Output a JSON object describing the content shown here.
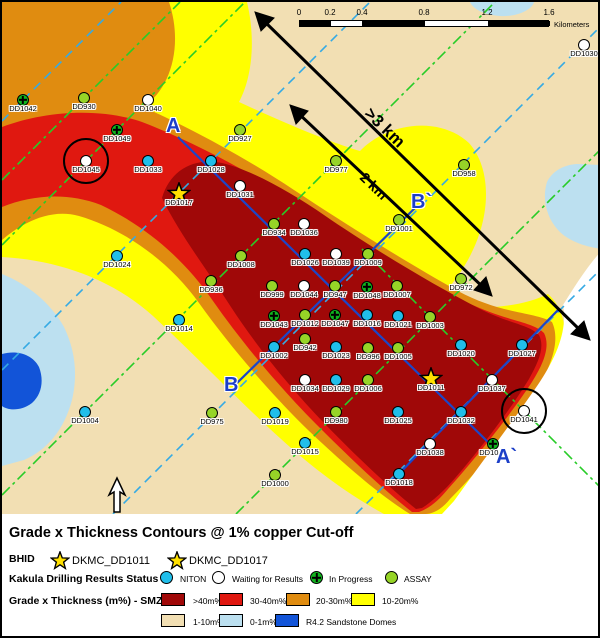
{
  "map": {
    "section_labels": {
      "a": "A",
      "a_prime": "A`",
      "b": "B",
      "b_prime": "B`"
    },
    "distance_labels": {
      "long": ">3 km",
      "short": "2 km"
    },
    "scalebar": {
      "ticks": [
        "0",
        "0.2",
        "0.4",
        "0.8",
        "1.2",
        "1.6"
      ],
      "unit": "Kilometers"
    },
    "region_colors": {
      "gt40": "#A00808",
      "r30_40": "#E01810",
      "r20_30": "#E08C10",
      "r10_20": "#FFFF00",
      "r1_10": "#F2DFB3",
      "r0_1": "#BCE0F0",
      "sandstone_dome": "#1254D8",
      "no_data": "#FFFFFF"
    },
    "status_colors": {
      "niton": "#20BEEA",
      "waiting": "#FFFFFF",
      "inprogress": "#10B41E",
      "assay": "#96D427",
      "star": "#FFE000"
    },
    "holes": [
      {
        "label": "DD1030",
        "x": 582,
        "y": 43,
        "status": "waiting"
      },
      {
        "label": "DD1042",
        "x": 21,
        "y": 98,
        "status": "inprogress"
      },
      {
        "label": "DD930",
        "x": 82,
        "y": 96,
        "status": "assay"
      },
      {
        "label": "DD1040",
        "x": 146,
        "y": 98,
        "status": "waiting"
      },
      {
        "label": "DD1049",
        "x": 115,
        "y": 128,
        "status": "inprogress"
      },
      {
        "label": "DD1045",
        "x": 84,
        "y": 159,
        "status": "waiting",
        "circled": true
      },
      {
        "label": "DD1033",
        "x": 146,
        "y": 159,
        "status": "niton"
      },
      {
        "label": "DD1028",
        "x": 209,
        "y": 159,
        "status": "niton"
      },
      {
        "label": "DD927",
        "x": 238,
        "y": 128,
        "status": "assay"
      },
      {
        "label": "DD977",
        "x": 334,
        "y": 159,
        "status": "assay"
      },
      {
        "label": "DD958",
        "x": 462,
        "y": 163,
        "status": "assay"
      },
      {
        "label": "DD1017",
        "x": 177,
        "y": 192,
        "status": "star"
      },
      {
        "label": "DD1031",
        "x": 238,
        "y": 184,
        "status": "waiting"
      },
      {
        "label": "DD934",
        "x": 272,
        "y": 222,
        "status": "assay"
      },
      {
        "label": "DD1036",
        "x": 302,
        "y": 222,
        "status": "waiting"
      },
      {
        "label": "DD1001",
        "x": 397,
        "y": 218,
        "status": "assay"
      },
      {
        "label": "DD1024",
        "x": 115,
        "y": 254,
        "status": "niton"
      },
      {
        "label": "DD1008",
        "x": 239,
        "y": 254,
        "status": "assay"
      },
      {
        "label": "DD1026",
        "x": 303,
        "y": 252,
        "status": "niton"
      },
      {
        "label": "DD1039",
        "x": 334,
        "y": 252,
        "status": "waiting"
      },
      {
        "label": "DD1009",
        "x": 366,
        "y": 252,
        "status": "assay"
      },
      {
        "label": "DD972",
        "x": 459,
        "y": 277,
        "status": "assay"
      },
      {
        "label": "DD936",
        "x": 209,
        "y": 279,
        "status": "assay"
      },
      {
        "label": "DD999",
        "x": 270,
        "y": 284,
        "status": "assay"
      },
      {
        "label": "DD1044",
        "x": 302,
        "y": 284,
        "status": "waiting"
      },
      {
        "label": "DD947",
        "x": 333,
        "y": 284,
        "status": "assay"
      },
      {
        "label": "DD1048",
        "x": 365,
        "y": 285,
        "status": "inprogress"
      },
      {
        "label": "DD1007",
        "x": 395,
        "y": 284,
        "status": "assay"
      },
      {
        "label": "DD1014",
        "x": 177,
        "y": 318,
        "status": "niton"
      },
      {
        "label": "DD1043",
        "x": 272,
        "y": 314,
        "status": "inprogress"
      },
      {
        "label": "DD1012",
        "x": 303,
        "y": 313,
        "status": "assay"
      },
      {
        "label": "DD1047",
        "x": 333,
        "y": 313,
        "status": "inprogress"
      },
      {
        "label": "DD1016",
        "x": 365,
        "y": 313,
        "status": "niton"
      },
      {
        "label": "DD1021",
        "x": 396,
        "y": 314,
        "status": "niton"
      },
      {
        "label": "DD1003",
        "x": 428,
        "y": 315,
        "status": "assay"
      },
      {
        "label": "DD942",
        "x": 303,
        "y": 337,
        "status": "assay"
      },
      {
        "label": "DD1002",
        "x": 272,
        "y": 345,
        "status": "niton"
      },
      {
        "label": "DD1023",
        "x": 334,
        "y": 345,
        "status": "niton"
      },
      {
        "label": "DD996",
        "x": 366,
        "y": 346,
        "status": "assay"
      },
      {
        "label": "DD1005",
        "x": 396,
        "y": 346,
        "status": "assay"
      },
      {
        "label": "DD1020",
        "x": 459,
        "y": 343,
        "status": "niton"
      },
      {
        "label": "DD1027",
        "x": 520,
        "y": 343,
        "status": "niton"
      },
      {
        "label": "DD1034",
        "x": 303,
        "y": 378,
        "status": "waiting"
      },
      {
        "label": "DD1029",
        "x": 334,
        "y": 378,
        "status": "niton"
      },
      {
        "label": "DD1006",
        "x": 366,
        "y": 378,
        "status": "assay"
      },
      {
        "label": "DD1011",
        "x": 429,
        "y": 377,
        "status": "star"
      },
      {
        "label": "DD1037",
        "x": 490,
        "y": 378,
        "status": "waiting"
      },
      {
        "label": "DD1004",
        "x": 83,
        "y": 410,
        "status": "niton"
      },
      {
        "label": "DD975",
        "x": 210,
        "y": 411,
        "status": "assay"
      },
      {
        "label": "DD1019",
        "x": 273,
        "y": 411,
        "status": "niton"
      },
      {
        "label": "DD980",
        "x": 334,
        "y": 410,
        "status": "assay"
      },
      {
        "label": "DD1025",
        "x": 396,
        "y": 410,
        "status": "niton"
      },
      {
        "label": "DD1032",
        "x": 459,
        "y": 410,
        "status": "niton"
      },
      {
        "label": "DD1041",
        "x": 522,
        "y": 409,
        "status": "waiting",
        "circled": true
      },
      {
        "label": "DD1015",
        "x": 303,
        "y": 441,
        "status": "niton"
      },
      {
        "label": "DD1038",
        "x": 428,
        "y": 442,
        "status": "waiting"
      },
      {
        "label": "DD1046",
        "x": 491,
        "y": 442,
        "status": "inprogress"
      },
      {
        "label": "DD1000",
        "x": 273,
        "y": 473,
        "status": "assay"
      },
      {
        "label": "DD1018",
        "x": 397,
        "y": 472,
        "status": "niton"
      }
    ]
  },
  "legend": {
    "title": "Grade x Thickness Contours @ 1% copper Cut-off",
    "bhid_label": "BHID",
    "bhid_items": [
      {
        "label": "DKMC_DD1011"
      },
      {
        "label": "DKMC_DD1017"
      }
    ],
    "status_label": "Kakula Drilling Results Status",
    "status_items": [
      {
        "label": "NITON",
        "type": "niton"
      },
      {
        "label": "Waiting for Results",
        "type": "waiting"
      },
      {
        "label": "In Progress",
        "type": "inprogress"
      },
      {
        "label": "ASSAY",
        "type": "assay"
      }
    ],
    "grade_label": "Grade x Thickness (m%) - SMZ10",
    "grade_items_row1": [
      {
        "label": ">40m%",
        "color": "#A00808"
      },
      {
        "label": "30-40m%",
        "color": "#E01810"
      },
      {
        "label": "20-30m%",
        "color": "#E08C10"
      },
      {
        "label": "10-20m%",
        "color": "#FFFF00"
      }
    ],
    "grade_items_row2": [
      {
        "label": "1-10m%",
        "color": "#F2DFB3"
      },
      {
        "label": "0-1m%",
        "color": "#BCE0F0"
      },
      {
        "label": "R4.2 Sandstone Domes",
        "color": "#1254D8"
      }
    ]
  }
}
